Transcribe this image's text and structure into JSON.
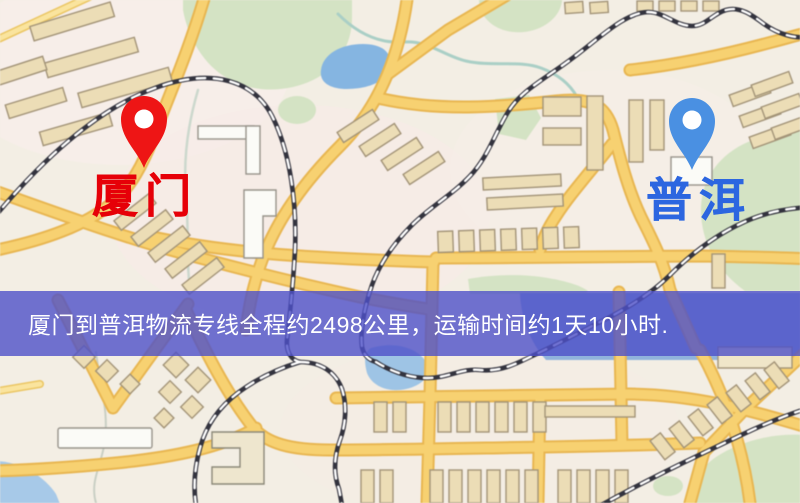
{
  "type": "route-map-graphic",
  "origin": {
    "name": "厦门",
    "pin_color": "#ee1515",
    "label_color": "#e60008"
  },
  "destination": {
    "name": "普洱",
    "pin_color": "#4a90e2",
    "label_color": "#2c66e0"
  },
  "banner": {
    "text": "厦门到普洱物流专线全程约2498公里，运输时间约1天10小时.",
    "bg_color": "rgba(77,80,200,0.8)",
    "text_color": "#ffffff"
  },
  "route_facts": {
    "from": "厦门",
    "to": "普洱",
    "distance_km": 2498,
    "duration": "1天10小时"
  },
  "map_palette": {
    "background": "#f3eee4",
    "road": "#f8d16e",
    "road_casing": "#e9b64e",
    "railway": "#33333e",
    "water": "#84b5e3",
    "park": "#d4e3c3",
    "building": "#ecddb5"
  }
}
